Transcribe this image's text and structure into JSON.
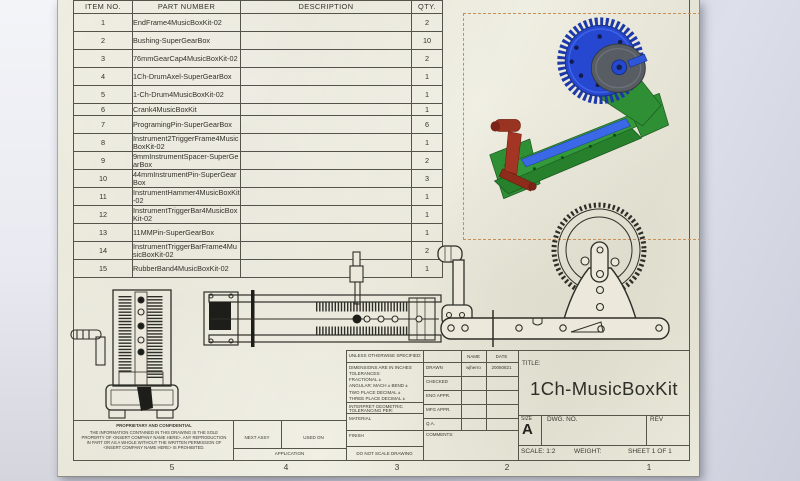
{
  "sheet": {
    "bom": {
      "headers": [
        "ITEM NO.",
        "PART NUMBER",
        "DESCRIPTION",
        "QTY."
      ],
      "rows": [
        {
          "item": "1",
          "part": "EndFrame4MusicBoxKit-02",
          "description": "",
          "qty": "2"
        },
        {
          "item": "2",
          "part": "Bushing-SuperGearBox",
          "description": "",
          "qty": "10"
        },
        {
          "item": "3",
          "part": "76mmGearCap4MusicBoxKit-02",
          "description": "",
          "qty": "2"
        },
        {
          "item": "4",
          "part": "1Ch-DrumAxel-SuperGearBox",
          "description": "",
          "qty": "1"
        },
        {
          "item": "5",
          "part": "1-Ch-Drum4MusicBoxKit-02",
          "description": "",
          "qty": "1"
        },
        {
          "item": "6",
          "part": "Crank4MusicBoxKit",
          "description": "",
          "qty": "1"
        },
        {
          "item": "7",
          "part": "ProgramingPin-SuperGearBox",
          "description": "",
          "qty": "6"
        },
        {
          "item": "8",
          "part": "Instrument2TriggerFrame4MusicBoxKit-02",
          "description": "",
          "qty": "1"
        },
        {
          "item": "9",
          "part": "9mmInstrumentSpacer-SuperGearBox",
          "description": "",
          "qty": "2"
        },
        {
          "item": "10",
          "part": "44mmInstrumentPin-SuperGearBox",
          "description": "",
          "qty": "3"
        },
        {
          "item": "11",
          "part": "InstrumentHammer4MusicBoxKit-02",
          "description": "",
          "qty": "1"
        },
        {
          "item": "12",
          "part": "InstrumentTriggerBar4MusicBoxKit-02",
          "description": "",
          "qty": "1"
        },
        {
          "item": "13",
          "part": "11MMPin-SuperGearBox",
          "description": "",
          "qty": "1"
        },
        {
          "item": "14",
          "part": "InstrumentTriggerBarFrame4MusicBoxKit-02",
          "description": "",
          "qty": "2"
        },
        {
          "item": "15",
          "part": "RubberBand4MusicBoxKit-02",
          "description": "",
          "qty": "1"
        }
      ]
    },
    "zones": [
      "5",
      "4",
      "3",
      "2",
      "1"
    ],
    "proprietary": {
      "heading": "PROPRIETARY AND CONFIDENTIAL",
      "body": "THE INFORMATION CONTAINED IN THIS DRAWING IS THE SOLE PROPERTY OF <INSERT COMPANY NAME HERE>. ANY REPRODUCTION IN PART OR AS A WHOLE WITHOUT THE WRITTEN PERMISSION OF <INSERT COMPANY NAME HERE> IS PROHIBITED."
    },
    "application": {
      "next_assy": "NEXT ASSY",
      "used_on": "USED ON",
      "application": "APPLICATION"
    },
    "tolerance": {
      "unless": "UNLESS OTHERWISE SPECIFIED:",
      "lines": [
        "DIMENSIONS ARE IN INCHES",
        "TOLERANCES:",
        "FRACTIONAL ±",
        "ANGULAR: MACH ±   BEND ±",
        "TWO PLACE DECIMAL    ±",
        "THREE PLACE DECIMAL  ±"
      ],
      "interpret": [
        "INTERPRET GEOMETRIC",
        "TOLERANCING PER:"
      ],
      "material": "MATERIAL",
      "finish": "FINISH",
      "do_not_scale": "DO NOT SCALE DRAWING"
    },
    "approvals": {
      "name_header": "NAME",
      "date_header": "DATE",
      "rows": [
        {
          "label": "DRAWN",
          "name": "wjherro",
          "date": "20060821"
        },
        {
          "label": "CHECKED",
          "name": "",
          "date": ""
        },
        {
          "label": "ENG APPR.",
          "name": "",
          "date": ""
        },
        {
          "label": "MFG APPR.",
          "name": "",
          "date": ""
        },
        {
          "label": "Q.A.",
          "name": "",
          "date": ""
        },
        {
          "label": "COMMENTS:",
          "name": "",
          "date": ""
        }
      ]
    },
    "title_block": {
      "title_label": "TITLE:",
      "title": "1Ch-MusicBoxKit",
      "size_label": "SIZE",
      "size": "A",
      "dwg_no_label": "DWG. NO.",
      "rev_label": "REV",
      "scale": "SCALE: 1:2",
      "weight": "WEIGHT:",
      "sheet_of": "SHEET 1 OF 1"
    }
  },
  "colors": {
    "paper": "#eae8da",
    "line": "#565549",
    "selection_dash": "#c98d56",
    "gear_blue": "#2647cf",
    "gear_blue_dark": "#16307e",
    "disc_gray": "#585c63",
    "frame_green": "#2f8f35",
    "crank_red": "#a33524",
    "rod_blue": "#3b68e6",
    "background": "#cdd0dc"
  }
}
